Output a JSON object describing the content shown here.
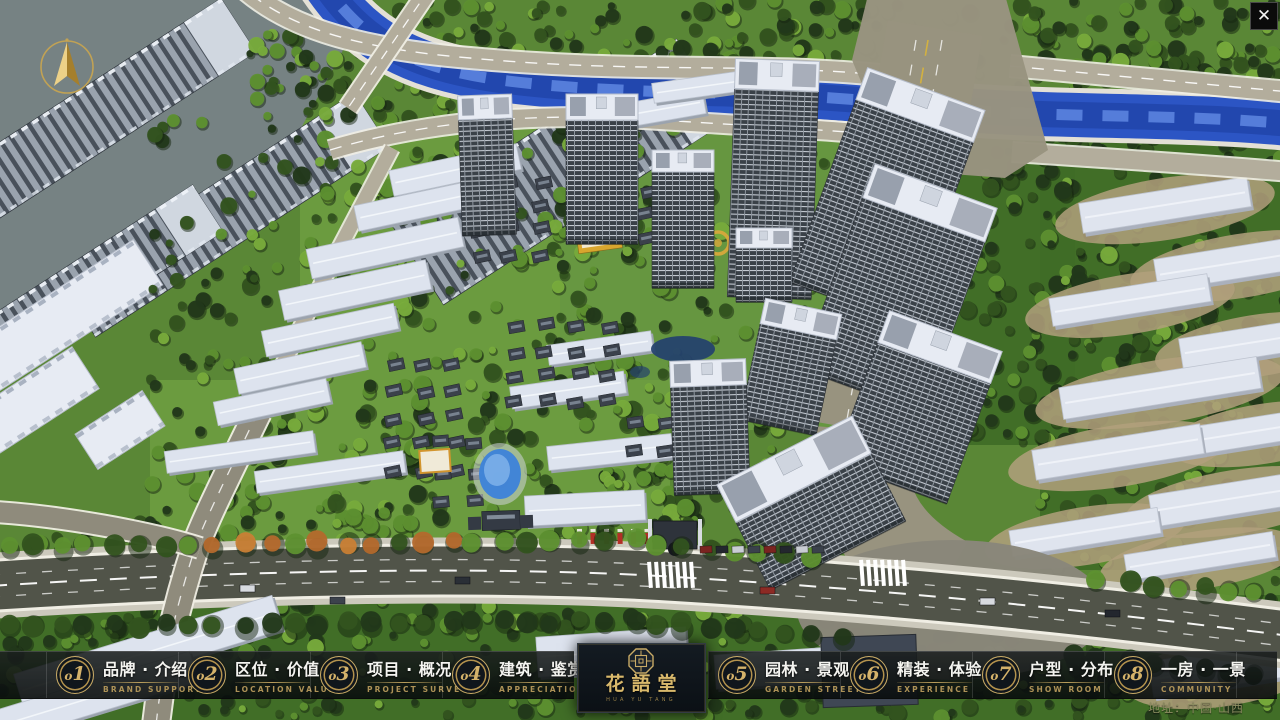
{
  "app": {
    "close_label": "✕"
  },
  "logo": {
    "title": "花語堂",
    "caption": "HUA YU TANG"
  },
  "hud": {
    "address": "地址：中国·山西"
  },
  "menu": {
    "items": [
      {
        "num": "o1",
        "label": "品牌 · 介绍",
        "sub": "BRAND SUPPORT"
      },
      {
        "num": "o2",
        "label": "区位 · 价值",
        "sub": "LOCATION VALUE"
      },
      {
        "num": "o3",
        "label": "项目 · 概况",
        "sub": "PROJECT SURVEY"
      },
      {
        "num": "o4",
        "label": "建筑 · 鉴赏",
        "sub": "APPRECIATION"
      },
      {
        "num": "o5",
        "label": "园林 · 景观",
        "sub": "GARDEN STREET"
      },
      {
        "num": "o6",
        "label": "精装 · 体验",
        "sub": "EXPERIENCE"
      },
      {
        "num": "o7",
        "label": "户型 · 分布",
        "sub": "SHOW ROOM"
      },
      {
        "num": "o8",
        "label": "一房 · 一景",
        "sub": "COMMUNITY"
      }
    ]
  },
  "colors": {
    "gold": "#c9ab66",
    "bar_bg": "#0c1010",
    "scene": {
      "grass": "#5a8736",
      "grass_light": "#6c9c40",
      "grass_mid": "#679741",
      "grass_dark": "#3f6b26",
      "tree_dark": "#22381a",
      "tree_mid": "#33531f",
      "tree_light": "#5e9130",
      "tree_bright": "#79ad3c",
      "river": "#2c55c4",
      "river_dark": "#1d3da0",
      "river_light": "#5e87e2",
      "bank": "#e3e0d6",
      "road_light": "#b3ad9c",
      "road_grey": "#98937f",
      "asphalt": "#515449",
      "sidewalk": "#ccc9bc",
      "line_white": "#f0eee4",
      "line_yellow": "#d9b53a",
      "roof_white": "#e7ebf3",
      "roof_shade": "#b6bdca",
      "facade": "#3a4148",
      "city_roof": "#d0d7e0",
      "city_dark": "#49515b",
      "city_mid": "#9aa3ae",
      "villa_roof": "#3b414b",
      "villa_ridge": "#78828f",
      "ground_tan": "#b2a07c",
      "pool": "#3f83d8",
      "pool_light": "#7fb1ea",
      "accent_gold": "#d2a73c",
      "accent_red": "#b23026"
    }
  }
}
